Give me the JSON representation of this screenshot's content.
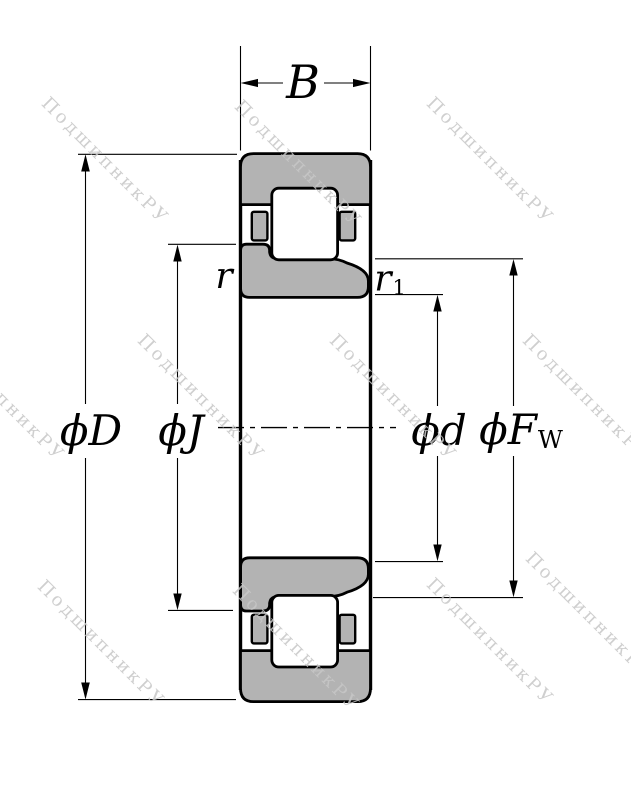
{
  "drawing_title": "cylindrical-roller-bearing-cross-section",
  "watermark": {
    "text": "ПодшипникРУ"
  },
  "labels": {
    "width": "B",
    "outer_diameter": "ϕD",
    "rib_diameter": "ϕJ",
    "bore_diameter": "ϕd",
    "raceway_diameter_main": "ϕF",
    "raceway_diameter_sub": "W",
    "chamfer_outer": "r",
    "chamfer_inner_main": "r",
    "chamfer_inner_sub": "1"
  },
  "colors": {
    "ring_fill": "#b3b3b3",
    "outline": "#000000",
    "watermark": "#c7c7c7",
    "background": "#ffffff"
  }
}
